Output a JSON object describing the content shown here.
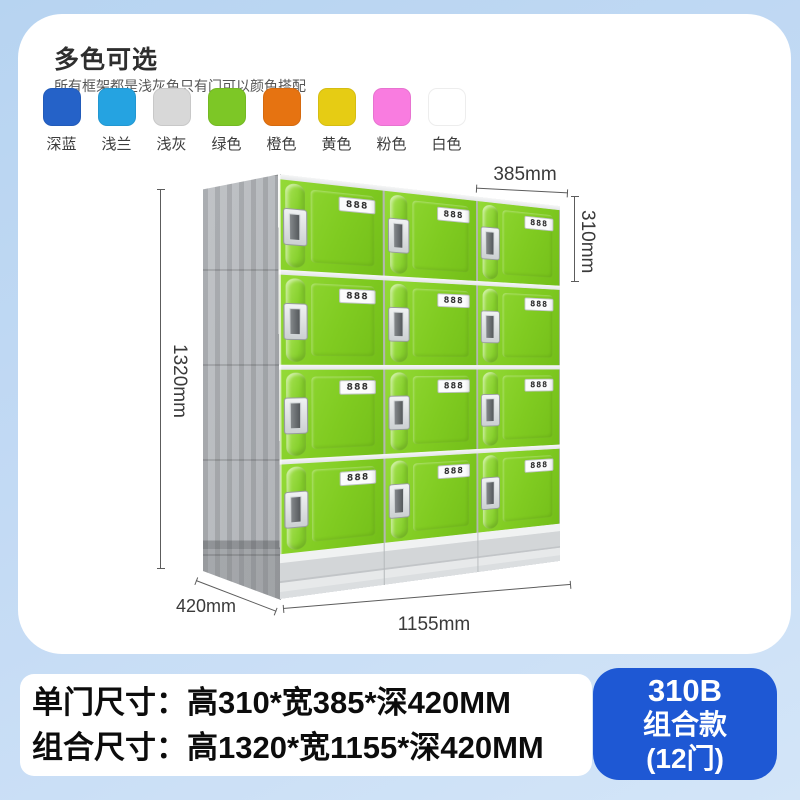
{
  "header": {
    "title": "多色可选",
    "subtitle": "所有框架都是浅灰色只有门可以颜色搭配"
  },
  "color_options": [
    {
      "label": "深蓝",
      "hex": "#2562c8"
    },
    {
      "label": "浅兰",
      "hex": "#25a3e1"
    },
    {
      "label": "浅灰",
      "hex": "#d8d8d8"
    },
    {
      "label": "绿色",
      "hex": "#7dc726"
    },
    {
      "label": "橙色",
      "hex": "#e67311"
    },
    {
      "label": "黄色",
      "hex": "#e6cc14"
    },
    {
      "label": "粉色",
      "hex": "#f97ce0"
    },
    {
      "label": "白色",
      "hex": "#ffffff"
    }
  ],
  "locker": {
    "rows": 4,
    "cols": 3,
    "door_count": 12,
    "lock_display": "888",
    "door_color": "#7ec922",
    "frame_color": "#b6b9bd",
    "dimensions": {
      "door_width": "385mm",
      "door_height": "310mm",
      "total_height": "1320mm",
      "depth": "420mm",
      "total_width": "1155mm"
    }
  },
  "footer": {
    "size_line1": "单门尺寸：高310*宽385*深420MM",
    "size_line2": "组合尺寸：高1320*宽1155*深420MM",
    "badge": {
      "line1": "310B",
      "line2": "组合款",
      "line3": "(12门)",
      "color": "#1e58d4"
    }
  }
}
